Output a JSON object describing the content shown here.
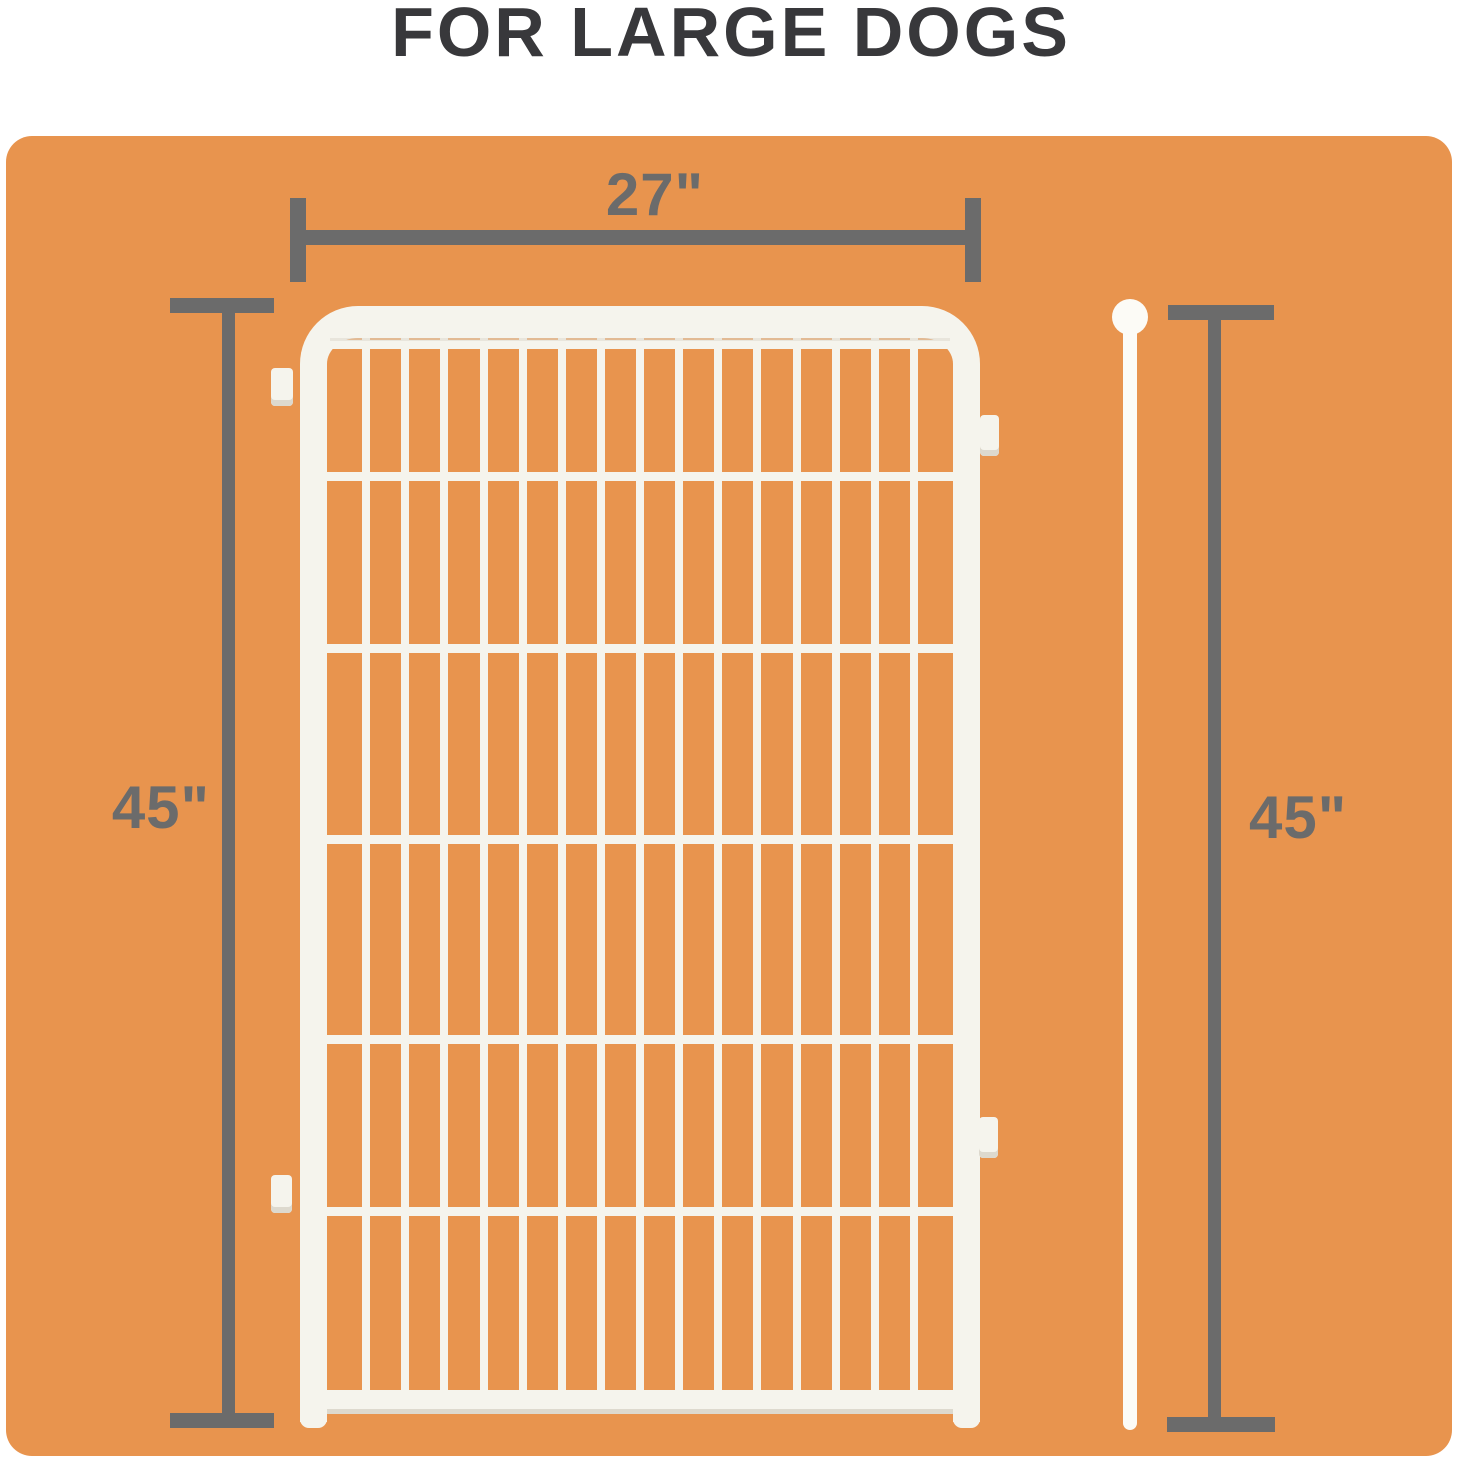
{
  "title": "FOR LARGE DOGS",
  "dimensions": {
    "width_label": "27\"",
    "height_label_left": "45\"",
    "height_label_right": "45\""
  },
  "gate": {
    "vertical_wire_count": 15,
    "horizontal_wire_offsets": [
      2,
      134,
      306,
      497,
      697,
      869
    ]
  },
  "colors": {
    "page_bg": "#FFFFFF",
    "card_orange": "#E8944E",
    "dimension_gray": "#6B6B6B",
    "title_text": "#38383B",
    "wire_white": "#F5F4ED",
    "bright_white": "#FCFBF6",
    "frame_shadow": "#DDD9CE"
  }
}
